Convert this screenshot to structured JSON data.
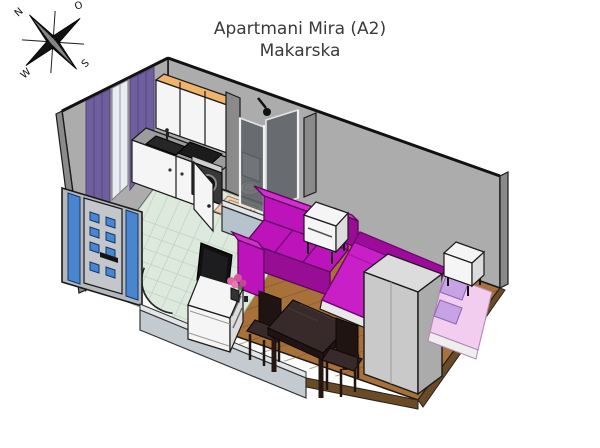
{
  "title": {
    "line1": "Apartmani Mira (A2)",
    "line2": "Makarska"
  },
  "compass": {
    "north": "N",
    "east": "O",
    "south": "S",
    "west": "W"
  },
  "colors": {
    "wall": "#acacac",
    "wall_dark": "#8a8a8a",
    "floor_wood": "#a9713a",
    "floor_wood_dark": "#7e5227",
    "floor_tile": "#dde9dd",
    "tile_line": "#bed2c0",
    "halfwall": "#b7c3cc",
    "halfwall_light": "#e0e5e9",
    "curtain": "#6f5f9e",
    "curtain_dark": "#534579",
    "door_blue": "#4a86cf",
    "sofa": "#bc13ba",
    "sofa_light": "#d02ece",
    "sofa_dark": "#970e95",
    "bed": "#c91fc7",
    "bed_dark": "#9c0b9a",
    "kids_bed": "#f2cdf0",
    "kids_pillow": "#c7a3e6",
    "white_furn": "#f5f5f5",
    "white_furn_shade": "#dcdcdc",
    "table": "#38292a",
    "table_dark": "#1f1412",
    "appliance_dark": "#383838",
    "glass_shower": "#5f6468",
    "tray": "#eed3bd",
    "cabinet_top": "#efb469",
    "counter": "#9c9c9c",
    "tv": "#101010",
    "flower": "#e068a8"
  }
}
